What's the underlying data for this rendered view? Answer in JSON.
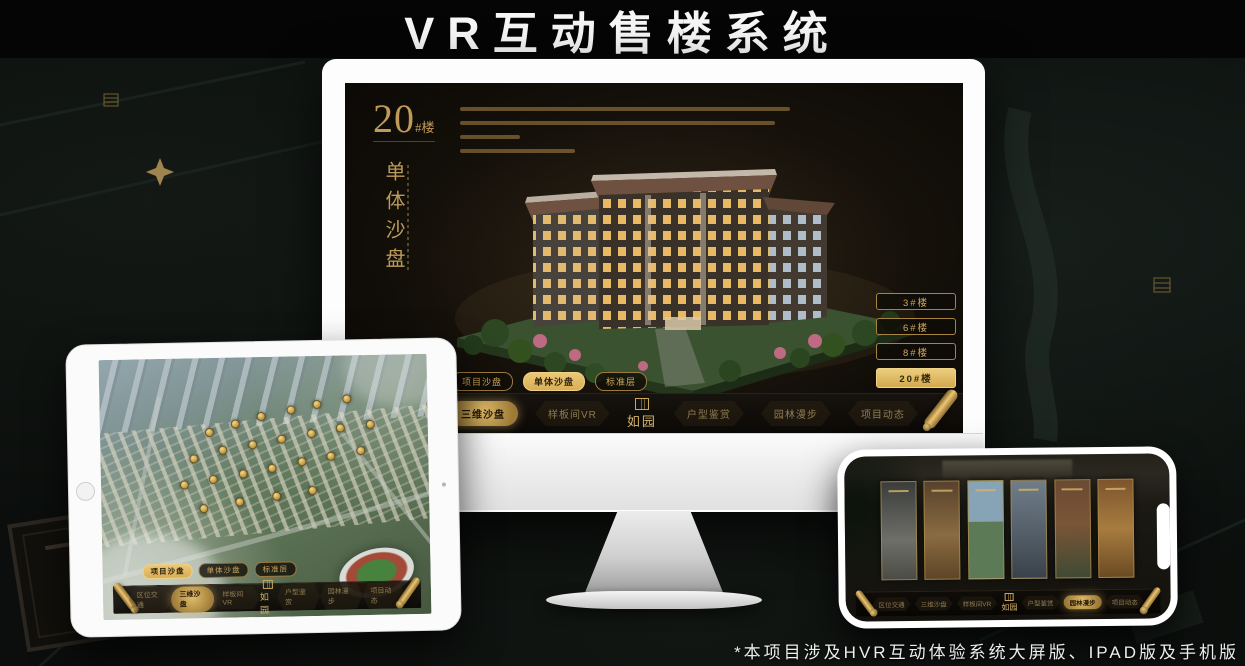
{
  "page": {
    "title": "VR互动售楼系统",
    "footnote": "*本项目涉及HVR互动体验系统大屏版、IPAD版及手机版"
  },
  "colors": {
    "gold": "#cfa95c",
    "gold_bright": "#ecc878",
    "screen_background": "#130f09",
    "selected_text": "#2f2410"
  },
  "nav": {
    "logo": "如园",
    "items": [
      {
        "label": "区位交通"
      },
      {
        "label": "三维沙盘"
      },
      {
        "label": "样板间VR"
      },
      {
        "label": "户型鉴赏"
      },
      {
        "label": "园林漫步"
      },
      {
        "label": "项目动态"
      }
    ]
  },
  "sub_tabs": [
    {
      "label": "项目沙盘"
    },
    {
      "label": "单体沙盘"
    },
    {
      "label": "标准层"
    }
  ],
  "monitor": {
    "heading": {
      "number": "20",
      "suffix": "#楼",
      "vertical": "单体沙盘"
    },
    "active_sub_tab": "单体沙盘",
    "active_nav_item": "三维沙盘",
    "floor_buttons": [
      {
        "label": "3#楼",
        "selected": false
      },
      {
        "label": "6#楼",
        "selected": false
      },
      {
        "label": "8#楼",
        "selected": false
      },
      {
        "label": "20#楼",
        "selected": true
      }
    ]
  },
  "ipad": {
    "active_sub_tab": "项目沙盘",
    "active_nav_item": "三维沙盘",
    "badges": [
      [
        32,
        27
      ],
      [
        40,
        24
      ],
      [
        48,
        21
      ],
      [
        57,
        19
      ],
      [
        65,
        17
      ],
      [
        74,
        15
      ],
      [
        27,
        37
      ],
      [
        36,
        34
      ],
      [
        45,
        32
      ],
      [
        54,
        30
      ],
      [
        63,
        28
      ],
      [
        72,
        26
      ],
      [
        81,
        25
      ],
      [
        24,
        47
      ],
      [
        33,
        45
      ],
      [
        42,
        43
      ],
      [
        51,
        41
      ],
      [
        60,
        39
      ],
      [
        69,
        37
      ],
      [
        78,
        35
      ],
      [
        30,
        56
      ],
      [
        41,
        54
      ],
      [
        52,
        52
      ],
      [
        63,
        50
      ]
    ]
  },
  "phone": {
    "active_nav_item": "园林漫步"
  }
}
